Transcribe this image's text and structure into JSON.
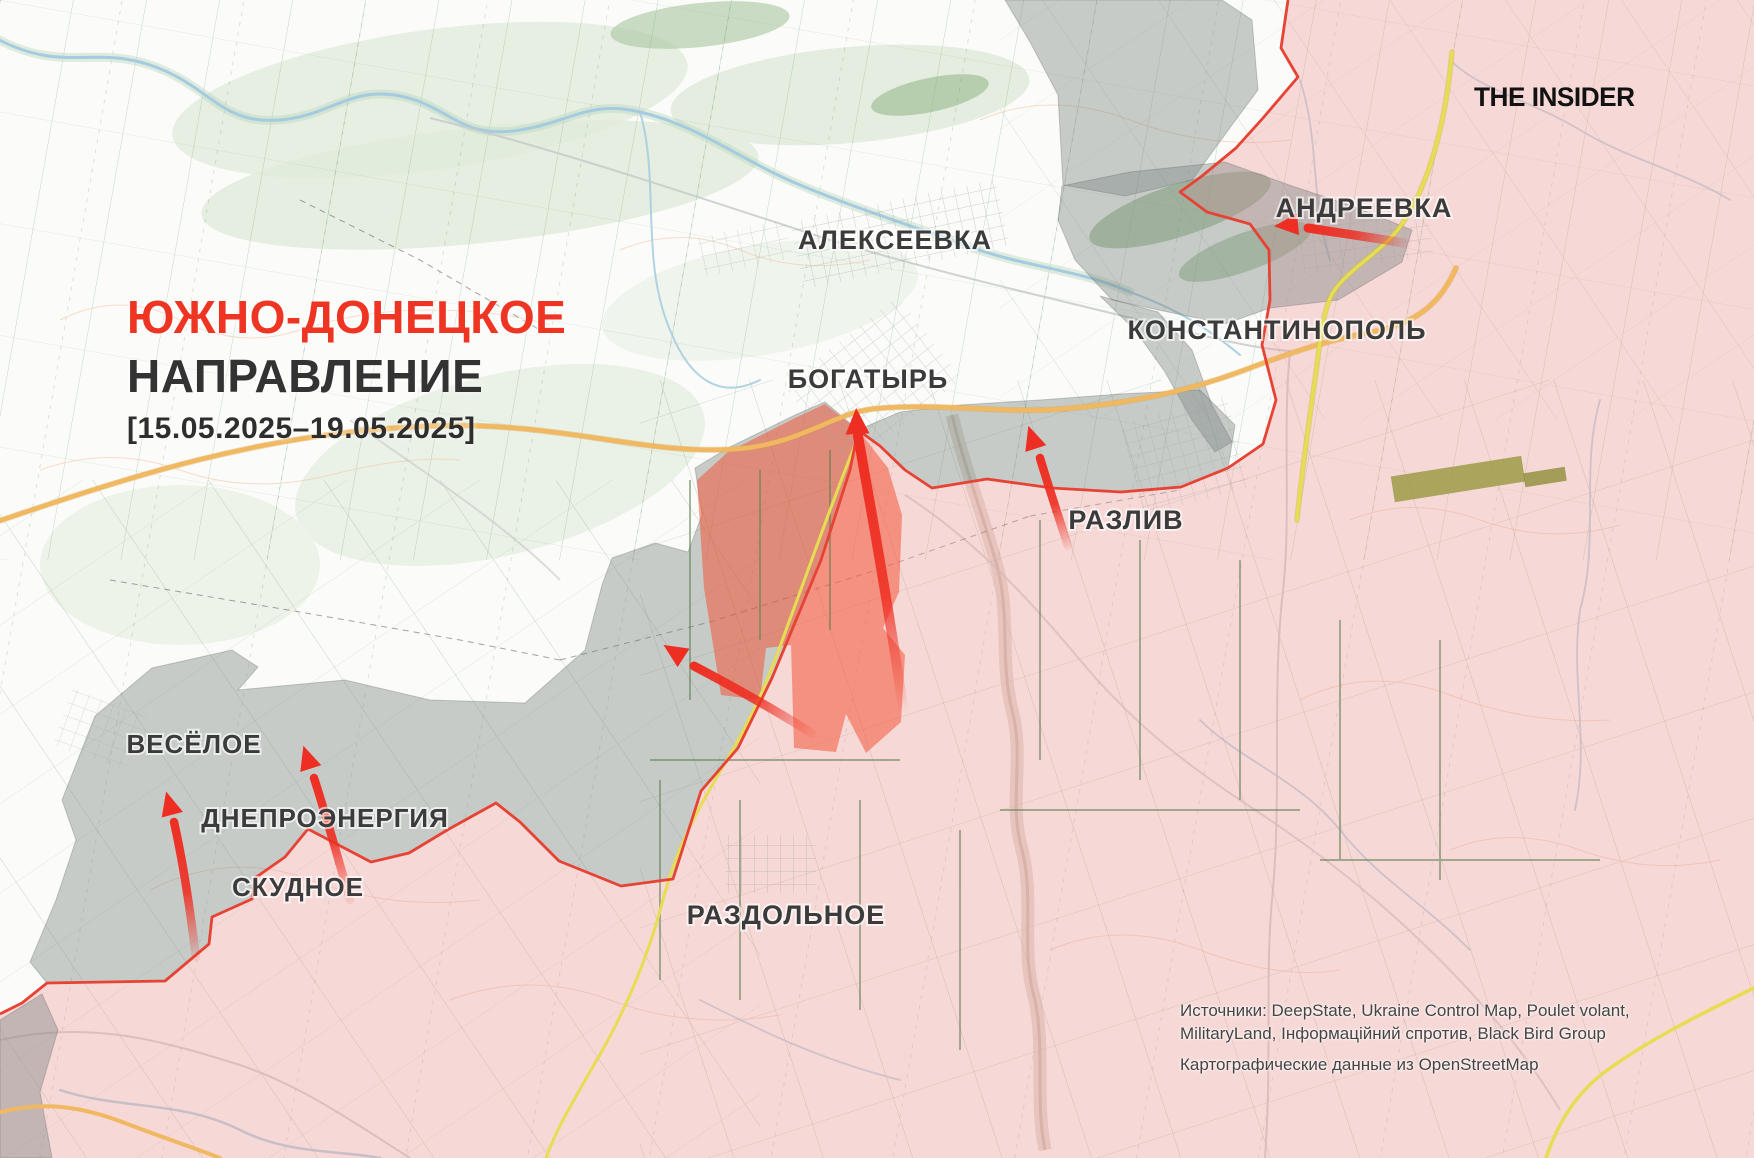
{
  "title": {
    "line1": "ЮЖНО-ДОНЕЦКОЕ",
    "line2": "НАПРАВЛЕНИЕ",
    "date_range": "[15.05.2025–19.05.2025]"
  },
  "logo": "THE INSIDER",
  "towns": [
    {
      "name": "АЛЕКСЕЕВКА"
    },
    {
      "name": "АНДРЕЕВКА"
    },
    {
      "name": "КОНСТАНТИНОПОЛЬ"
    },
    {
      "name": "БОГАТЫРЬ"
    },
    {
      "name": "РАЗЛИВ"
    },
    {
      "name": "ВЕСЁЛОЕ"
    },
    {
      "name": "ДНЕПРОЭНЕРГИЯ"
    },
    {
      "name": "СКУДНОЕ"
    },
    {
      "name": "РАЗДОЛЬНОЕ"
    }
  ],
  "attribution": {
    "sources_line1": "Источники: DeepState, Ukraine Control Map, Poulet volant,",
    "sources_line2": "MilitaryLand, Інформаційний спротив, Black Bird Group",
    "cartography": "Картографические данные из OpenStreetMap"
  },
  "map": {
    "arrows": [
      {
        "name": "advance-arrow-andreevka"
      },
      {
        "name": "advance-arrow-bogatyr"
      },
      {
        "name": "advance-arrow-west"
      },
      {
        "name": "advance-arrow-razliv"
      },
      {
        "name": "advance-arrow-veseloe"
      },
      {
        "name": "advance-arrow-dneproenergia"
      }
    ],
    "colors": {
      "title_red": "#ee3524",
      "frontline_red": "#e64334",
      "arrow_red": "#ee2e22",
      "occupied_pink": "rgba(238,152,152,0.36)",
      "contested_gray": "rgba(120,130,128,0.40)",
      "advance_red": "rgba(243,80,50,0.52)",
      "road_orange": "#f1b862",
      "road_yellow": "#e6dd52",
      "river_blue": "#a4cbdf",
      "label_dark": "#3b3b3b"
    }
  }
}
